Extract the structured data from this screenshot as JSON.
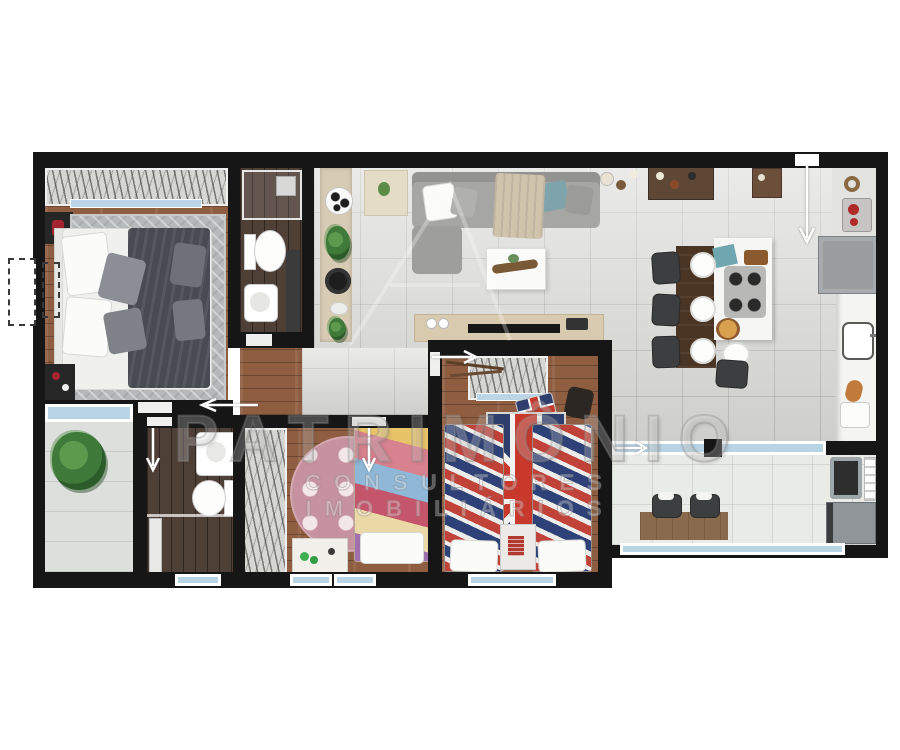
{
  "watermark": {
    "line1": "PATRIMÔNIO",
    "line2": "CONSULTORES IMOBILIÁRIOS"
  },
  "plan": {
    "type": "apartment-floor-plan-3d-top-view",
    "rooms": [
      {
        "id": "master-bedroom",
        "floor": "wood",
        "furniture": [
          "wardrobe-closet",
          "double-bed",
          "herringbone-rug",
          "nightstand",
          "bench",
          "balcony-sliding-window"
        ]
      },
      {
        "id": "bathroom-top",
        "floor": "dark-wood",
        "furniture": [
          "shower-box",
          "toilet",
          "sink-cabinet",
          "vanity"
        ]
      },
      {
        "id": "living-dining-kitchen",
        "floor": "gray-tile",
        "furniture": [
          "sofa-l-shape",
          "coffee-table",
          "tv-console",
          "tv",
          "side-table",
          "decor-shelf",
          "soccer-ball",
          "plant",
          "sideboard",
          "bar-cart",
          "dining-table",
          "chairs",
          "plates",
          "kitchen-island",
          "cooktop",
          "fridge",
          "counter",
          "coffee-machine",
          "sink"
        ]
      },
      {
        "id": "balcony-left",
        "floor": "light-tile",
        "furniture": [
          "fern-plant"
        ]
      },
      {
        "id": "bathroom-bottom",
        "floor": "dark-wood",
        "furniture": [
          "sink",
          "toilet",
          "shower-column",
          "glass-screen"
        ]
      },
      {
        "id": "kids-room-girl",
        "floor": "wood",
        "furniture": [
          "closet",
          "pink-polkadot-rug",
          "single-bed-colorful",
          "desk",
          "toys"
        ]
      },
      {
        "id": "kids-room-boys",
        "floor": "wood",
        "furniture": [
          "closet",
          "uk-flag-rug",
          "single-bed-uk",
          "single-bed-uk",
          "nightstand",
          "uk-pillow",
          "boots"
        ]
      },
      {
        "id": "service-office-area",
        "floor": "light-tile",
        "furniture": [
          "desk",
          "two-chairs",
          "laundry-sink",
          "drying-rack",
          "washing-machine",
          "window-band"
        ]
      }
    ],
    "colors": {
      "wall": "#161616",
      "wood_floor": "#8f5e41",
      "dark_wood_floor": "#4e3f37",
      "tile_floor": "#d9d9d6",
      "glass": "#b9d4e4",
      "accent_red": "#c8392c",
      "uk_navy": "#2e3f6e",
      "pink_rug": "#c7929f",
      "sofa_gray": "#a6a6a4",
      "counter_white": "#f4f4f2"
    }
  }
}
